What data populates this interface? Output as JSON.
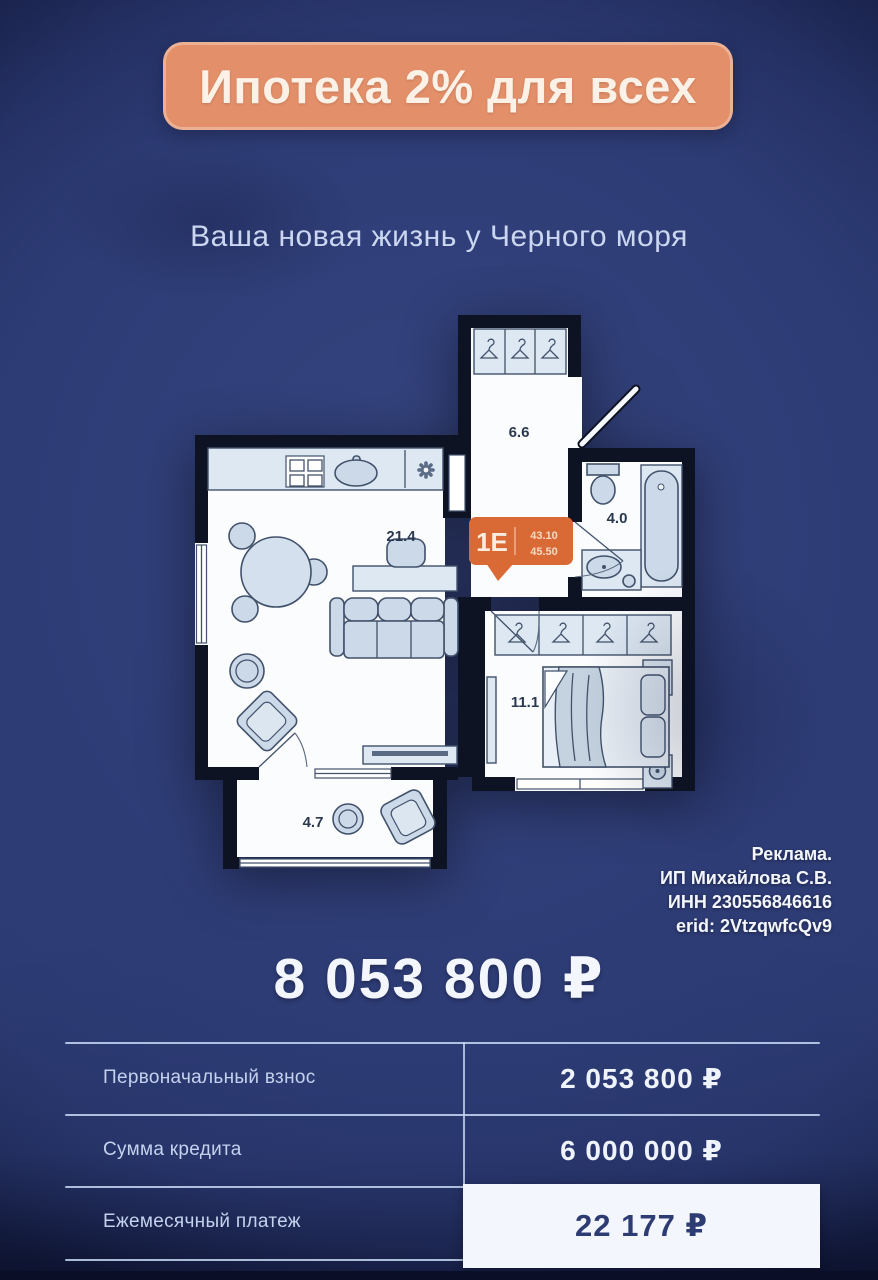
{
  "banner": {
    "text": "Ипотека 2% для всех"
  },
  "subtitle": {
    "text": "Ваша новая жизнь у Черного моря"
  },
  "floor_plan": {
    "unit_badge": {
      "type": "1Е",
      "area_living": "43.10",
      "area_total": "45.50"
    },
    "rooms": [
      {
        "name": "kitchen-living-room",
        "area": "21.4"
      },
      {
        "name": "hallway",
        "area": "6.6"
      },
      {
        "name": "bathroom",
        "area": "4.0"
      },
      {
        "name": "bedroom",
        "area": "11.1"
      },
      {
        "name": "balcony",
        "area": "4.7"
      }
    ]
  },
  "disclosure": {
    "lines": [
      "Реклама.",
      "ИП Михайлова С.В.",
      "ИНН 230556846616",
      "erid: 2VtzqwfcQv9"
    ]
  },
  "price": {
    "text": "8 053 800 ₽"
  },
  "table": {
    "rows": [
      {
        "label": "Первоначальный взнос",
        "value": "2 053 800 ₽"
      },
      {
        "label": "Сумма кредита",
        "value": "6 000 000 ₽"
      },
      {
        "label": "Ежемесячный платеж",
        "value": "22 177 ₽"
      }
    ]
  },
  "colors": {
    "background": "#2e3c76",
    "banner_bg": "#e28f6a",
    "badge": "#d96a35",
    "text": "#f3f7fd"
  }
}
